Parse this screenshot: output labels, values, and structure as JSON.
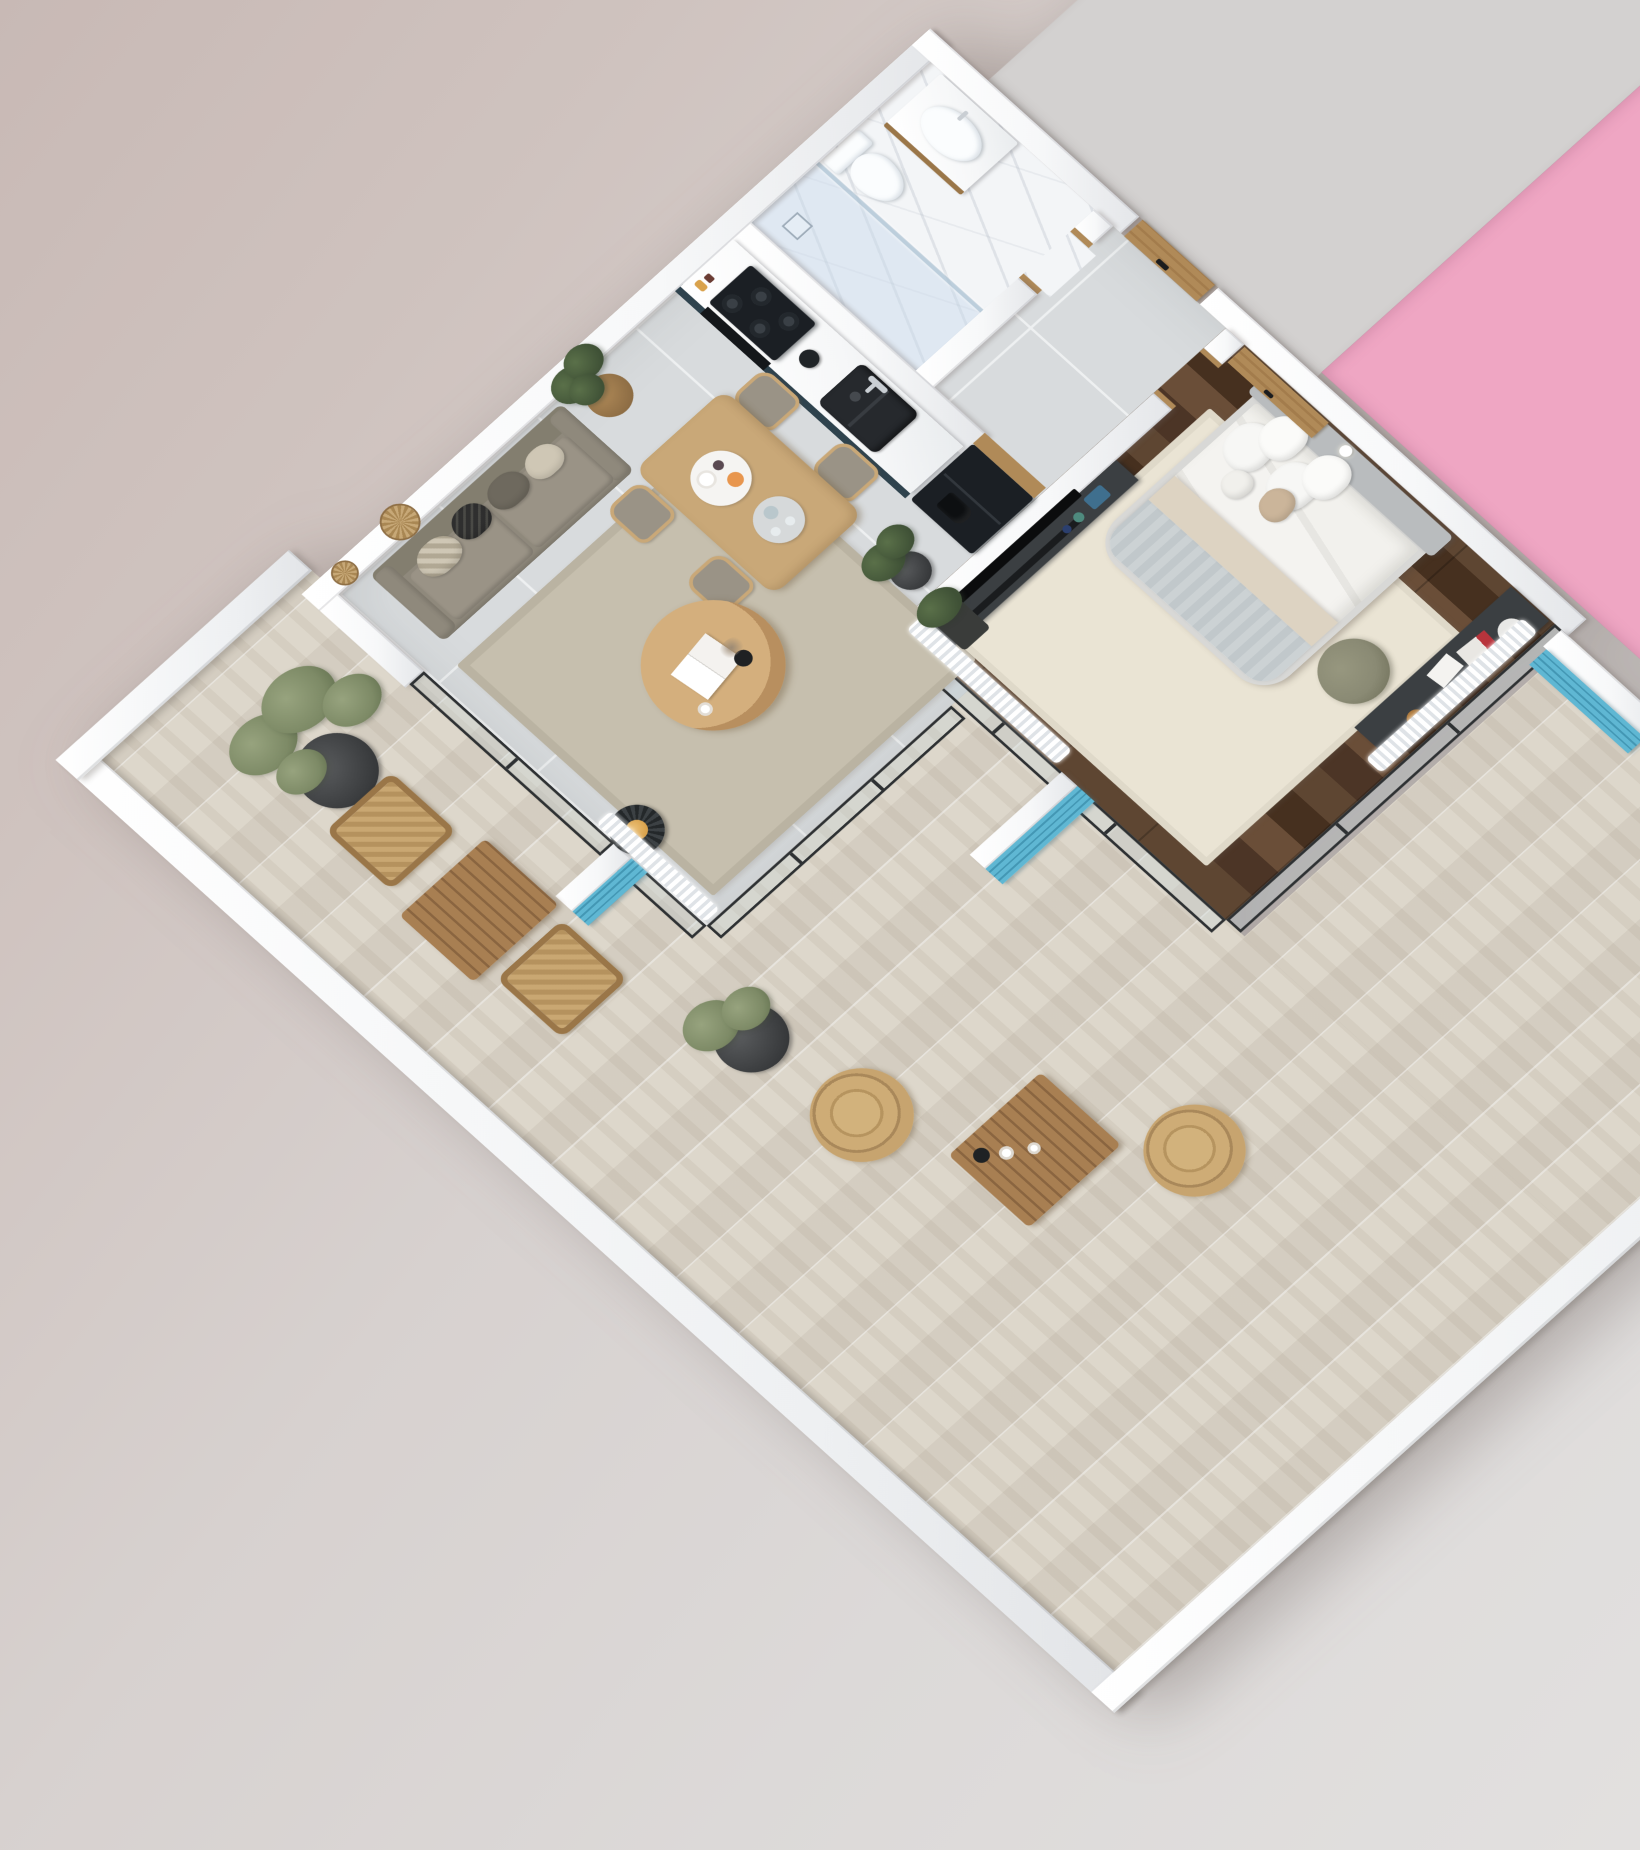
{
  "scene": {
    "kind": "3d-isometric-apartment-floor-plan-render",
    "has_text": false
  },
  "palette": {
    "bg_top_left": "#c8b9b5",
    "bg_mid": "#d7d1cf",
    "bg_bottom": "#e2e0df",
    "wall_white": "#f7f8f9",
    "wall_shade": "#e4e6e9",
    "tile_floor": "#d8dbdd",
    "tile_grout": "#eef0f1",
    "terrace_floor": "#ddd7cb",
    "bedroom_floor": "#56402e",
    "bedroom_floor_dark": "#46301f",
    "marble_floor": "#f3f5f7",
    "neighbor_pink": "#efa6c3",
    "neighbor_gray": "#d3d1d0",
    "accent_blue": "#5fb7d3",
    "accent_blue_dark": "#4397b4",
    "cabinet_teal": "#2f434e",
    "counter_marble": "#f6f7f8",
    "appliance_black": "#1b1f24",
    "sink_black": "#26292d",
    "oak_wood": "#c9a878",
    "walnut_door": "#b08a58",
    "sofa_taupe": "#8f897c",
    "sofa_cushion": "#9a9386",
    "rug_living": "#c6bfae",
    "rug_bedroom": "#eae4d4",
    "bedding_white": "#f4f3f0",
    "blanket_gray": "#ccd2d4",
    "blanket_beige": "#ddd3c2",
    "headboard_gray": "#b9bcbe",
    "desk_charcoal": "#3b3f42",
    "pouf_olive": "#8a8a74",
    "rattan": "#c9a772",
    "rattan_dark": "#9a7648",
    "plant_green": "#3f5136",
    "olive_green": "#7d8a66",
    "lantern_amber": "#d9a24c",
    "ceramic_white": "#fbfdfe",
    "glass_frame": "#2e3133",
    "glass_tint": "rgba(190,210,220,0.25)",
    "curtain_white": "#ffffff"
  },
  "rooms": [
    {
      "id": "living-room",
      "floor": "tile_floor",
      "items": [
        "sofa",
        "throw-pillows",
        "rattan-wall-fans",
        "cage-side-table-with-lantern",
        "area-rug",
        "round-coffee-table",
        "open-magazine",
        "coffee-cup",
        "vase",
        "potted-plant",
        "dining-table",
        "dining-chairs-x4",
        "breakfast-tray",
        "drink-tray",
        "sheer-curtain",
        "sliding-glass-door"
      ]
    },
    {
      "id": "kitchen",
      "floor": "tile_floor",
      "items": [
        "teal-cabinet-run",
        "marble-counter",
        "gas-hob",
        "oven",
        "utensil-cup",
        "black-double-sink",
        "faucet",
        "slat-backsplash",
        "refrigerator"
      ]
    },
    {
      "id": "bathroom",
      "floor": "marble_floor",
      "items": [
        "walk-in-shower",
        "glass-partition",
        "floor-drain",
        "toilet",
        "vanity",
        "vessel-sink",
        "faucet",
        "door-jambs"
      ]
    },
    {
      "id": "hallway",
      "floor": "tile_floor",
      "items": [
        "entrance-door",
        "door-thresholds"
      ]
    },
    {
      "id": "bedroom",
      "floor": "bedroom_floor",
      "items": [
        "double-bed",
        "headboard",
        "pillows",
        "folded-blankets",
        "bedroom-rug",
        "media-console",
        "tv",
        "soundbar",
        "storage-box",
        "desk",
        "desk-magazine",
        "desk-tray",
        "pouf",
        "wall-sconce",
        "open-door",
        "sheer-curtains",
        "glass-walls",
        "corner-planter"
      ]
    },
    {
      "id": "terrace",
      "floor": "terrace_floor",
      "items": [
        "olive-tree",
        "lounge-armchair-x2",
        "slat-coffee-table-x2",
        "papasan-rattan-chair-x2",
        "potted-shrub",
        "privacy-screen-blue-x3",
        "parapet-walls",
        "coffee-cups",
        "candle-lamp"
      ]
    },
    {
      "id": "neighbor-unit",
      "items": [
        "gray-floor-slab",
        "pink-floor-slab"
      ]
    }
  ]
}
